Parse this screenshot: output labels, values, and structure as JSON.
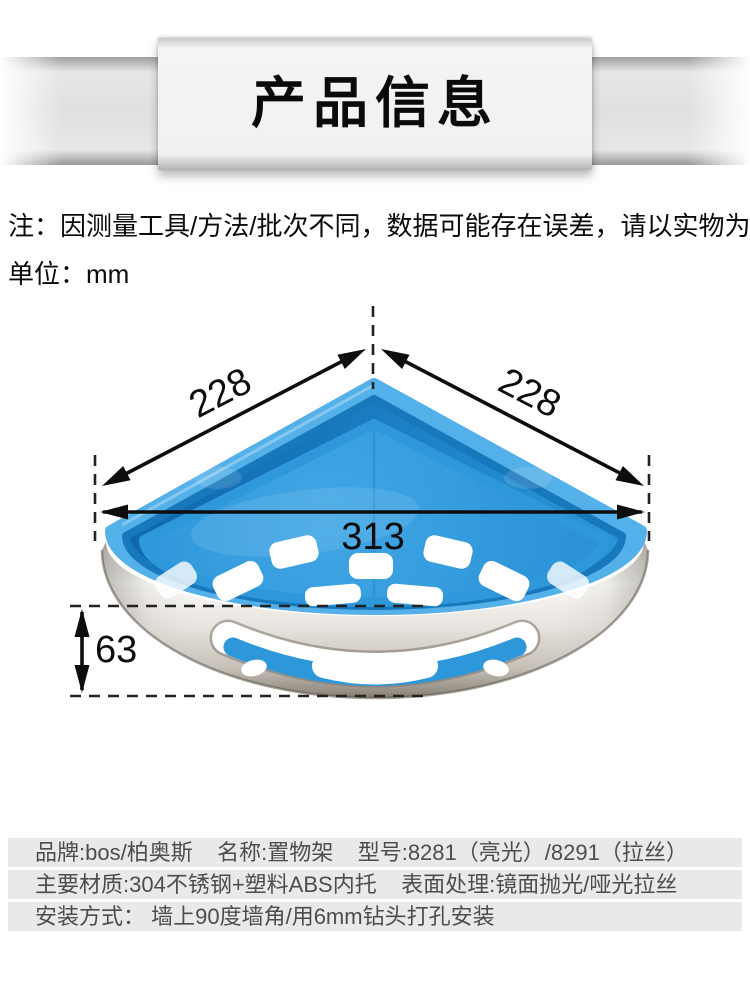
{
  "banner": {
    "title": "产品信息"
  },
  "notes": {
    "measure": "注：因测量工具/方法/批次不同，数据可能存在误差，请以实物为准！",
    "unit": "单位：mm"
  },
  "dimensions": {
    "left_edge": "228",
    "right_edge": "228",
    "front_width": "313",
    "wall_height": "63"
  },
  "specs": {
    "rows": [
      {
        "text": "品牌:bos/柏奥斯    名称:置物架    型号:8281（亮光）/8291（拉丝）"
      },
      {
        "text": "主要材质:304不锈钢+塑料ABS内托    表面处理:镜面抛光/哑光拉丝"
      },
      {
        "text": "安装方式： 墙上90度墙角/用6mm钻头打孔安装"
      }
    ]
  },
  "colors": {
    "tray_blue": "#2f98da",
    "rim_blue": "#54b0e8",
    "steel_light": "#fbfaf8",
    "steel_dark": "#7b7266",
    "row_background": "#e9e9e9",
    "text_dark": "#0d0d0d",
    "spec_text": "#4d4d4d"
  }
}
